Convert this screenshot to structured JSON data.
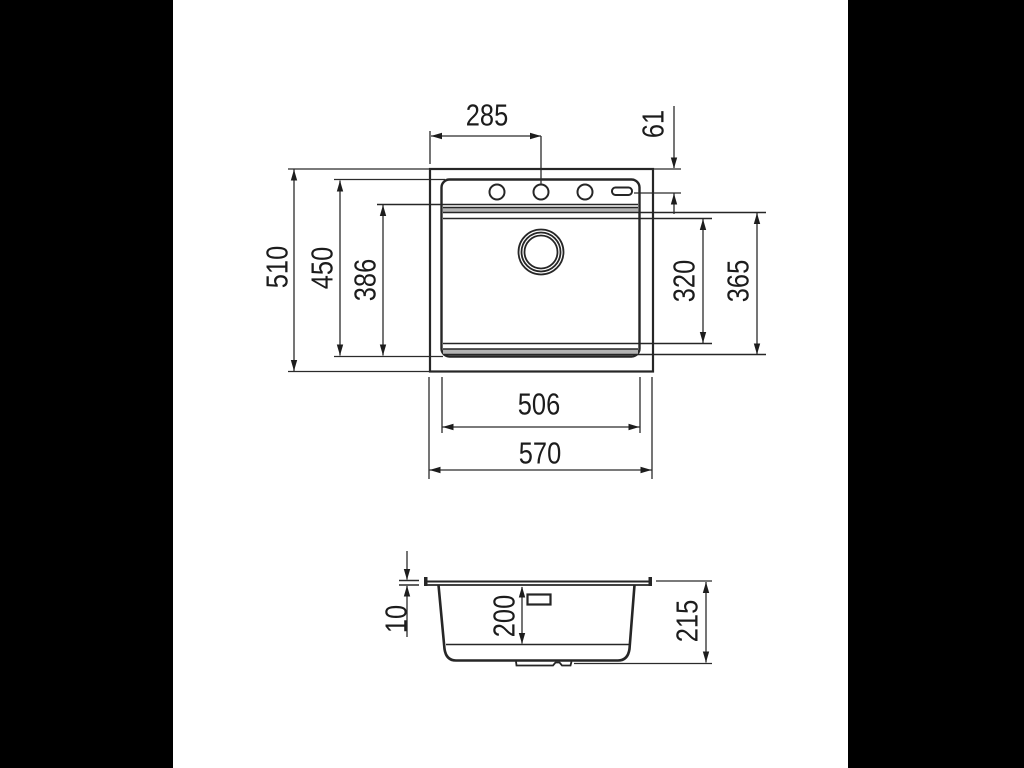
{
  "drawing": {
    "kind": "technical dimension drawing",
    "subject": "inset kitchen sink, top view and side section view"
  },
  "colors": {
    "background_bars": "#000000",
    "paper": "#ffffff",
    "line": "#262626",
    "ledge_band_fill": "#b3b3b3",
    "slot_fill": "#c2c2c2",
    "label_text": "#1c1c1c"
  },
  "top_view": {
    "dims": [
      {
        "id": "left-edge-to-center-hole",
        "value": "285",
        "orientation": "horizontal"
      },
      {
        "id": "top-edge-to-hole-axis",
        "value": "61",
        "orientation": "vertical"
      },
      {
        "id": "overall-depth",
        "value": "510",
        "orientation": "vertical"
      },
      {
        "id": "rim-opening-depth",
        "value": "450",
        "orientation": "vertical"
      },
      {
        "id": "ledge-depth",
        "value": "386",
        "orientation": "vertical"
      },
      {
        "id": "bowl-opening-depth",
        "value": "320",
        "orientation": "vertical"
      },
      {
        "id": "bowl-outer-depth",
        "value": "365",
        "orientation": "vertical"
      },
      {
        "id": "rim-opening-width",
        "value": "506",
        "orientation": "horizontal"
      },
      {
        "id": "overall-width",
        "value": "570",
        "orientation": "horizontal"
      }
    ]
  },
  "side_view": {
    "dims": [
      {
        "id": "flange-thickness",
        "value": "10",
        "orientation": "vertical"
      },
      {
        "id": "bowl-inner-depth",
        "value": "200",
        "orientation": "vertical"
      },
      {
        "id": "overall-height",
        "value": "215",
        "orientation": "vertical"
      }
    ]
  }
}
